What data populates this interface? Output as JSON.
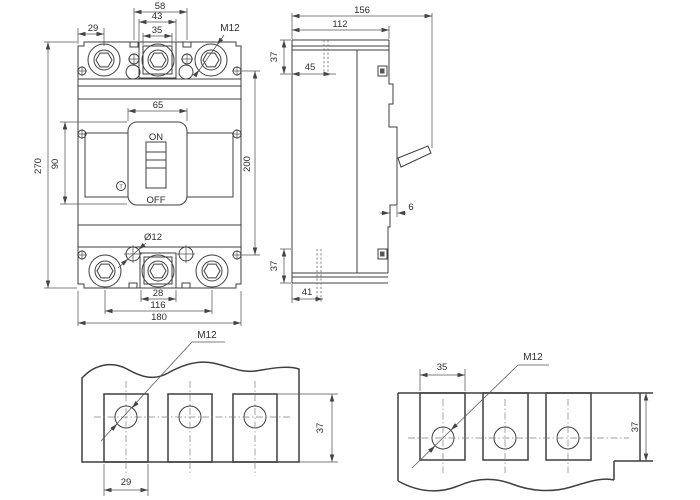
{
  "colors": {
    "line": "#3f3f3f",
    "dim": "#555555",
    "background": "#ffffff"
  },
  "front_view": {
    "dim_top_pitch": "58",
    "dim_top_pad_outer": "43",
    "dim_top_pad_inner": "35",
    "dim_edge_to_pole": "29",
    "thread_callout": "M12",
    "dim_recess_width": "65",
    "switch_on": "ON",
    "switch_off": "OFF",
    "trip_button": "T",
    "dim_height": "270",
    "dim_recess_height": "90",
    "dim_mount_height": "200",
    "hole_callout": "Ø12",
    "dim_pad_width": "28",
    "dim_pole_span": "116",
    "dim_width": "180"
  },
  "side_view": {
    "dim_depth_total": "156",
    "dim_depth_body": "112",
    "dim_terminal_height_top": "37",
    "dim_hole_offset_top": "45",
    "dim_step": "6",
    "dim_terminal_height_bottom": "37",
    "dim_hole_offset_bottom": "41"
  },
  "detail_bottom_left": {
    "thread_callout": "M12",
    "dim_pad_width": "29",
    "dim_strip_height": "37"
  },
  "detail_bottom_right": {
    "thread_callout": "M12",
    "dim_pad_width": "35",
    "dim_strip_height": "37"
  }
}
